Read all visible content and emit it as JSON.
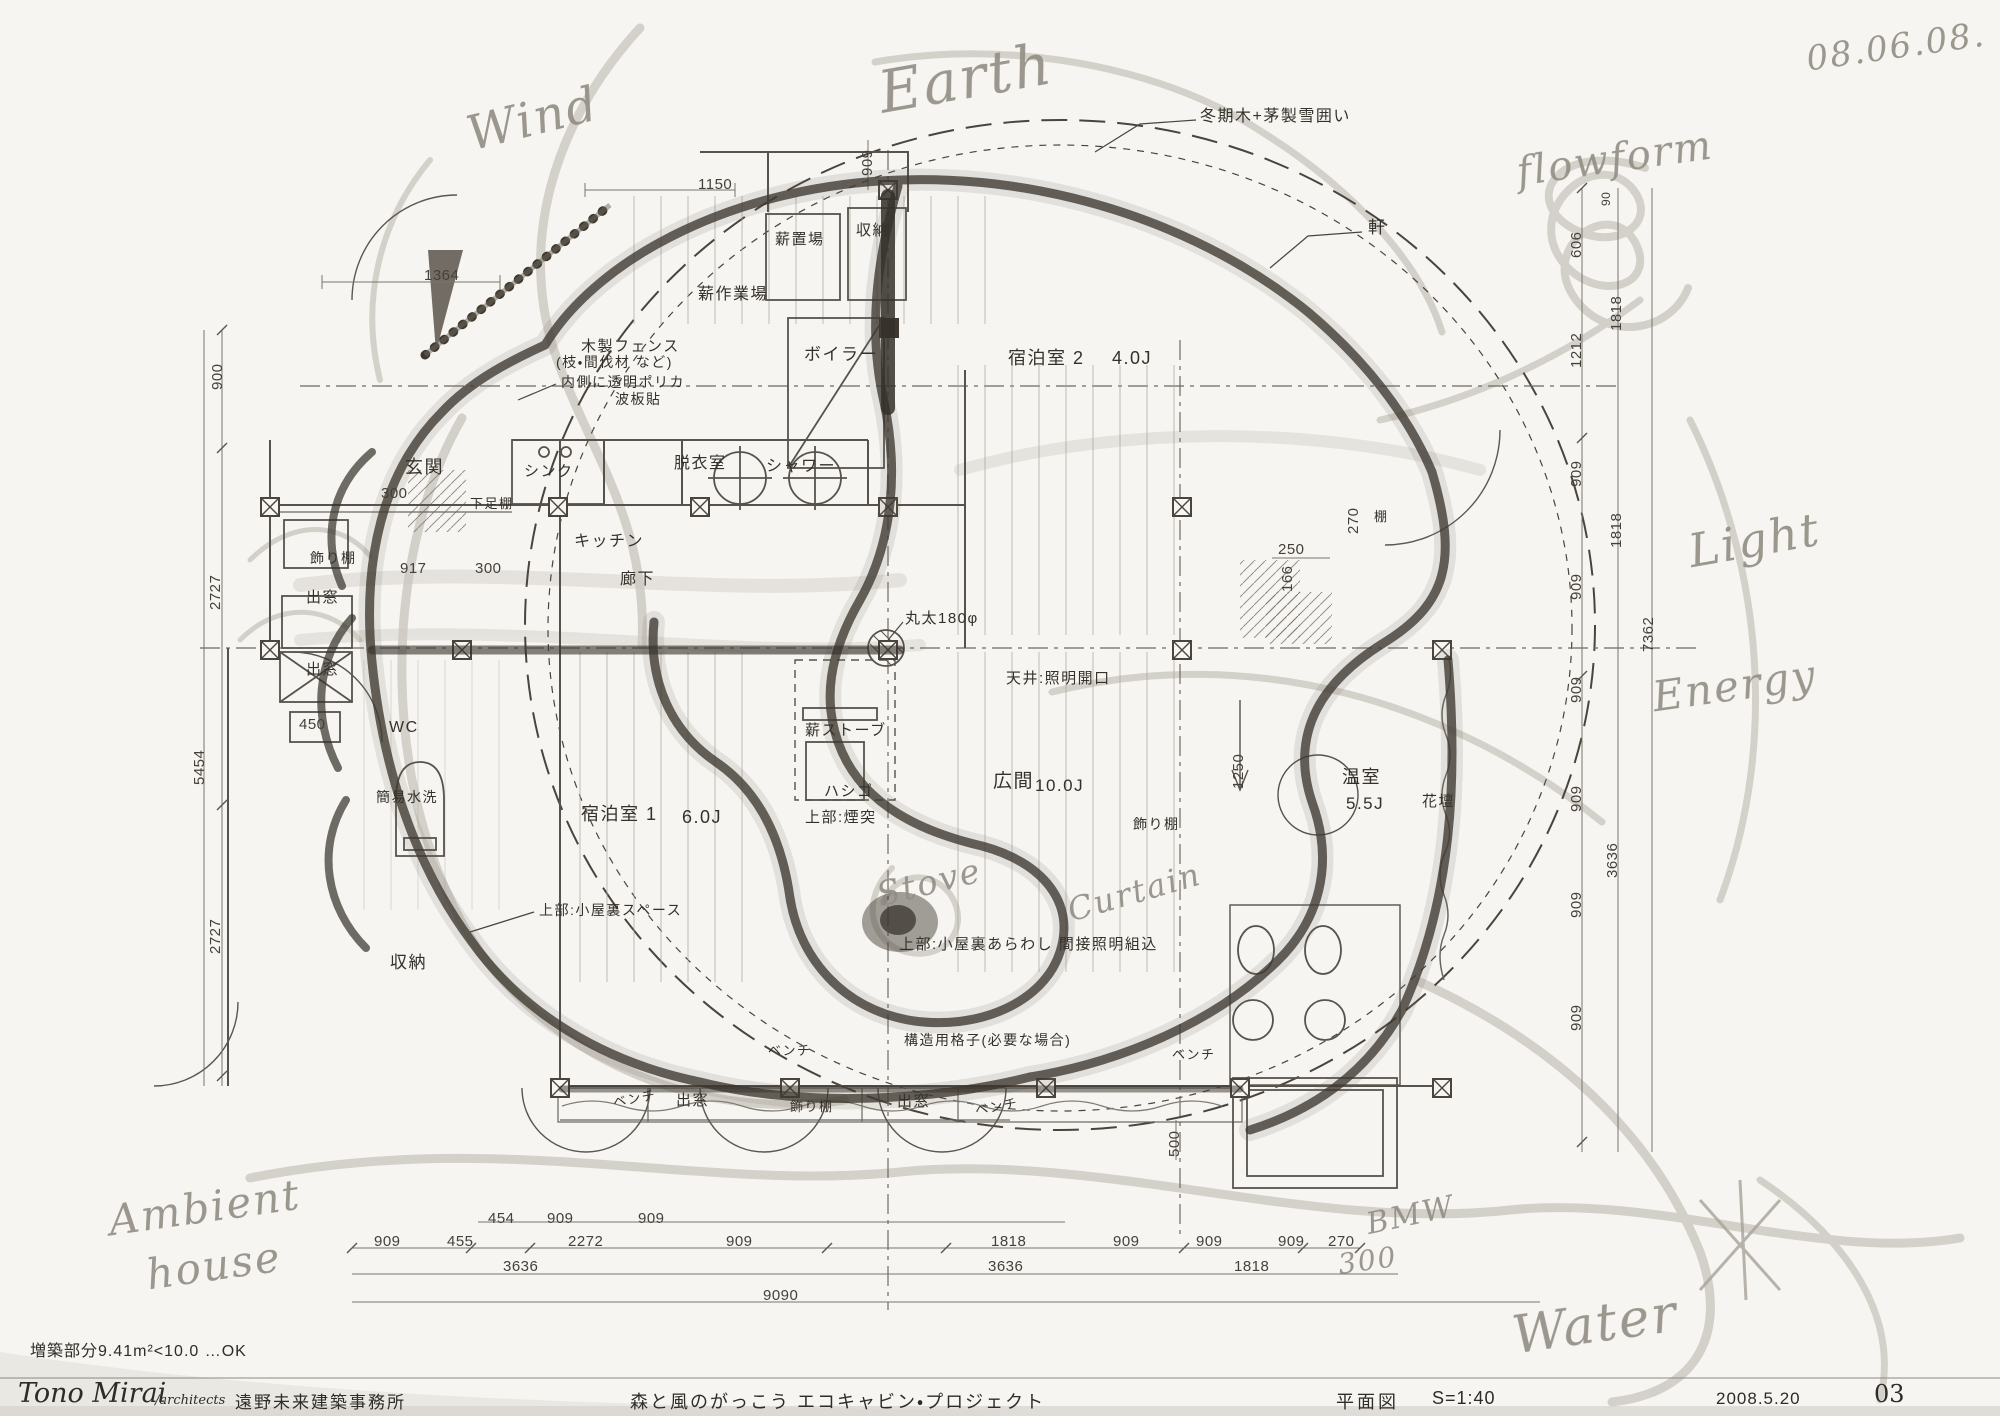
{
  "colors": {
    "paper": "#f6f5f1",
    "ink": "#3a352e",
    "pencil": "#b6b1a7",
    "heavy": "#3e3830"
  },
  "plan": {
    "room_labels": [
      {
        "name": "note-winter-cover",
        "text": "冬期木+茅製雪囲い",
        "x": 1200,
        "y": 109,
        "fs": 16
      },
      {
        "name": "note-eave",
        "text": "軒",
        "x": 1368,
        "y": 219,
        "fs": 17
      },
      {
        "name": "room-firewood-storage",
        "text": "薪置場",
        "x": 775,
        "y": 232,
        "fs": 15
      },
      {
        "name": "room-storage-top",
        "text": "収納",
        "x": 856,
        "y": 223,
        "fs": 15
      },
      {
        "name": "room-firewood-workspace",
        "text": "薪作業場",
        "x": 698,
        "y": 287,
        "fs": 16
      },
      {
        "name": "room-boiler",
        "text": "ボイラー",
        "x": 804,
        "y": 346,
        "fs": 17
      },
      {
        "name": "room-guest2",
        "text": "宿泊室 2",
        "x": 1008,
        "y": 349,
        "fs": 18
      },
      {
        "name": "room-guest2-size",
        "text": "4.0J",
        "x": 1112,
        "y": 349,
        "fs": 18
      },
      {
        "name": "note-wood-fence",
        "text": "木製フェンス",
        "x": 581,
        "y": 339,
        "fs": 15
      },
      {
        "name": "note-wood-fence2",
        "text": "(枝・間伐材 など)",
        "x": 556,
        "y": 355,
        "fs": 14
      },
      {
        "name": "note-polycarb",
        "text": "内側に透明ポリカ",
        "x": 561,
        "y": 375,
        "fs": 14
      },
      {
        "name": "note-polycarb2",
        "text": "波板貼",
        "x": 615,
        "y": 392,
        "fs": 14
      },
      {
        "name": "room-entrance",
        "text": "玄関",
        "x": 405,
        "y": 458,
        "fs": 18
      },
      {
        "name": "note-shoe-shelf",
        "text": "下足棚",
        "x": 470,
        "y": 497,
        "fs": 13
      },
      {
        "name": "fixture-sink",
        "text": "シンク",
        "x": 524,
        "y": 464,
        "fs": 15
      },
      {
        "name": "room-changing",
        "text": "脱衣室",
        "x": 674,
        "y": 456,
        "fs": 16
      },
      {
        "name": "room-shower",
        "text": "シャワー",
        "x": 766,
        "y": 459,
        "fs": 16
      },
      {
        "name": "room-kitchen",
        "text": "キッチン",
        "x": 574,
        "y": 534,
        "fs": 16
      },
      {
        "name": "room-corridor",
        "text": "廊下",
        "x": 620,
        "y": 572,
        "fs": 16
      },
      {
        "name": "fixture-shelf-left",
        "text": "飾り棚",
        "x": 310,
        "y": 551,
        "fs": 14
      },
      {
        "name": "fixture-baywindow-1",
        "text": "出窓",
        "x": 306,
        "y": 590,
        "fs": 15
      },
      {
        "name": "fixture-baywindow-2",
        "text": "出窓",
        "x": 306,
        "y": 662,
        "fs": 15
      },
      {
        "name": "room-wc",
        "text": "WC",
        "x": 389,
        "y": 720,
        "fs": 16
      },
      {
        "name": "fixture-toilet",
        "text": "簡易水洗",
        "x": 376,
        "y": 790,
        "fs": 14
      },
      {
        "name": "note-log-column",
        "text": "丸太180φ",
        "x": 905,
        "y": 611,
        "fs": 15
      },
      {
        "name": "note-ceiling-opening",
        "text": "天井:照明開口",
        "x": 1006,
        "y": 671,
        "fs": 15
      },
      {
        "name": "fixture-wood-stove",
        "text": "薪ストーブ",
        "x": 805,
        "y": 723,
        "fs": 15
      },
      {
        "name": "fixture-ladder",
        "text": "ハシゴ",
        "x": 824,
        "y": 784,
        "fs": 15
      },
      {
        "name": "note-chimney",
        "text": "上部:煙突",
        "x": 805,
        "y": 810,
        "fs": 15
      },
      {
        "name": "room-guest1",
        "text": "宿泊室 1",
        "x": 581,
        "y": 805,
        "fs": 18
      },
      {
        "name": "room-guest1-size",
        "text": "6.0J",
        "x": 682,
        "y": 808,
        "fs": 18
      },
      {
        "name": "room-hall",
        "text": "広間",
        "x": 993,
        "y": 772,
        "fs": 19
      },
      {
        "name": "room-hall-size",
        "text": "10.0J",
        "x": 1035,
        "y": 777,
        "fs": 17
      },
      {
        "name": "fixture-shelf-hall",
        "text": "飾り棚",
        "x": 1133,
        "y": 817,
        "fs": 14
      },
      {
        "name": "room-greenhouse",
        "text": "温室",
        "x": 1342,
        "y": 768,
        "fs": 18
      },
      {
        "name": "room-greenhouse-size",
        "text": "5.5J",
        "x": 1346,
        "y": 795,
        "fs": 17
      },
      {
        "name": "fixture-flowerbed",
        "text": "花壇",
        "x": 1422,
        "y": 794,
        "fs": 15
      },
      {
        "name": "fixture-shelf-small",
        "text": "棚",
        "x": 1374,
        "y": 510,
        "fs": 13
      },
      {
        "name": "room-storage-bottom",
        "text": "収納",
        "x": 390,
        "y": 954,
        "fs": 17
      },
      {
        "name": "note-attic-space",
        "text": "上部:小屋裏スペース",
        "x": 539,
        "y": 903,
        "fs": 14
      },
      {
        "name": "note-attic-exposed",
        "text": "上部:小屋裏あらわし 間接照明組込",
        "x": 899,
        "y": 937,
        "fs": 15
      },
      {
        "name": "note-lattice",
        "text": "構造用格子(必要な場合)",
        "x": 904,
        "y": 1033,
        "fs": 14
      },
      {
        "name": "fixture-bench-1",
        "text": "ベンチ",
        "x": 768,
        "y": 1044,
        "fs": 13
      },
      {
        "name": "fixture-bench-2",
        "text": "ベンチ",
        "x": 1172,
        "y": 1048,
        "fs": 13
      },
      {
        "name": "fixture-bench-3",
        "text": "ベンチ",
        "x": 613,
        "y": 1092,
        "fs": 13,
        "rot": -10
      },
      {
        "name": "fixture-baywindow-3",
        "text": "出窓",
        "x": 676,
        "y": 1093,
        "fs": 15
      },
      {
        "name": "fixture-shelf-bottom",
        "text": "飾り棚",
        "x": 790,
        "y": 1100,
        "fs": 13
      },
      {
        "name": "fixture-baywindow-4",
        "text": "出窓",
        "x": 897,
        "y": 1094,
        "fs": 15
      },
      {
        "name": "fixture-bench-4",
        "text": "ベンチ",
        "x": 975,
        "y": 1100,
        "fs": 13,
        "rot": -10
      }
    ],
    "dims_h": [
      {
        "text": "1150",
        "x": 698,
        "y": 177
      },
      {
        "text": "1364",
        "x": 424,
        "y": 268
      },
      {
        "text": "300",
        "x": 381,
        "y": 486
      },
      {
        "text": "917",
        "x": 400,
        "y": 561
      },
      {
        "text": "300",
        "x": 475,
        "y": 561
      },
      {
        "text": "450",
        "x": 299,
        "y": 717
      },
      {
        "text": "250",
        "x": 1278,
        "y": 542
      },
      {
        "text": "454",
        "x": 488,
        "y": 1211
      },
      {
        "text": "909",
        "x": 547,
        "y": 1211
      },
      {
        "text": "909",
        "x": 638,
        "y": 1211
      },
      {
        "text": "909",
        "x": 374,
        "y": 1234
      },
      {
        "text": "455",
        "x": 447,
        "y": 1234
      },
      {
        "text": "2272",
        "x": 568,
        "y": 1234
      },
      {
        "text": "909",
        "x": 726,
        "y": 1234
      },
      {
        "text": "1818",
        "x": 991,
        "y": 1234
      },
      {
        "text": "909",
        "x": 1113,
        "y": 1234
      },
      {
        "text": "909",
        "x": 1196,
        "y": 1234
      },
      {
        "text": "909",
        "x": 1278,
        "y": 1234
      },
      {
        "text": "270",
        "x": 1328,
        "y": 1234
      },
      {
        "text": "3636",
        "x": 503,
        "y": 1259
      },
      {
        "text": "3636",
        "x": 988,
        "y": 1259
      },
      {
        "text": "1818",
        "x": 1234,
        "y": 1259
      },
      {
        "text": "9090",
        "x": 763,
        "y": 1288
      }
    ],
    "dims_v": [
      {
        "text": "900",
        "x": 210,
        "y": 390
      },
      {
        "text": "2727",
        "x": 208,
        "y": 610
      },
      {
        "text": "5454",
        "x": 192,
        "y": 785
      },
      {
        "text": "2727",
        "x": 208,
        "y": 954
      },
      {
        "text": "909",
        "x": 860,
        "y": 176
      },
      {
        "text": "270",
        "x": 1346,
        "y": 534
      },
      {
        "text": "166",
        "x": 1280,
        "y": 592
      },
      {
        "text": "1250",
        "x": 1231,
        "y": 789
      },
      {
        "text": "500",
        "x": 1167,
        "y": 1157
      },
      {
        "text": "90",
        "x": 1600,
        "y": 206,
        "fs": 12
      },
      {
        "text": "606",
        "x": 1569,
        "y": 258
      },
      {
        "text": "1212",
        "x": 1569,
        "y": 368
      },
      {
        "text": "909",
        "x": 1569,
        "y": 487
      },
      {
        "text": "909",
        "x": 1569,
        "y": 600
      },
      {
        "text": "1818",
        "x": 1609,
        "y": 331
      },
      {
        "text": "1818",
        "x": 1609,
        "y": 548
      },
      {
        "text": "7362",
        "x": 1641,
        "y": 652
      },
      {
        "text": "909",
        "x": 1569,
        "y": 703
      },
      {
        "text": "909",
        "x": 1569,
        "y": 812
      },
      {
        "text": "909",
        "x": 1569,
        "y": 918
      },
      {
        "text": "909",
        "x": 1569,
        "y": 1031
      },
      {
        "text": "3636",
        "x": 1605,
        "y": 878
      }
    ],
    "handwritten": [
      {
        "name": "date-note",
        "text": "08.06.08.",
        "x": 1806,
        "y": 30,
        "fs": 34,
        "rot": -8
      },
      {
        "name": "note-earth",
        "text": "Earth",
        "x": 878,
        "y": 48,
        "fs": 58,
        "rot": -10
      },
      {
        "name": "note-wind",
        "text": "Wind",
        "x": 466,
        "y": 94,
        "fs": 48,
        "rot": -14
      },
      {
        "name": "note-flowform",
        "text": "flowform",
        "x": 1516,
        "y": 138,
        "fs": 40,
        "rot": -8
      },
      {
        "name": "note-light",
        "text": "Light",
        "x": 1688,
        "y": 516,
        "fs": 46,
        "rot": -10
      },
      {
        "name": "note-energy",
        "text": "Energy",
        "x": 1652,
        "y": 664,
        "fs": 42,
        "rot": -8
      },
      {
        "name": "note-stove",
        "text": "Stove",
        "x": 876,
        "y": 866,
        "fs": 34,
        "rot": -14
      },
      {
        "name": "note-curtain",
        "text": "Curtain",
        "x": 1066,
        "y": 876,
        "fs": 32,
        "rot": -16
      },
      {
        "name": "note-ambient",
        "text": "Ambient",
        "x": 108,
        "y": 1186,
        "fs": 42,
        "rot": -8
      },
      {
        "name": "note-house",
        "text": "house",
        "x": 146,
        "y": 1244,
        "fs": 42,
        "rot": -8
      },
      {
        "name": "note-bmw",
        "text": "BMW",
        "x": 1366,
        "y": 1200,
        "fs": 30,
        "rot": -12
      },
      {
        "name": "note-300-hand",
        "text": "300",
        "x": 1338,
        "y": 1246,
        "fs": 28,
        "rot": -8
      },
      {
        "name": "note-water",
        "text": "Water",
        "x": 1512,
        "y": 1298,
        "fs": 52,
        "rot": -8
      }
    ]
  },
  "footer": {
    "area_note": "増築部分9.41m²<10.0  …OK",
    "architect_name": "Tono Mirai",
    "architect_suffix": "/architects",
    "office": "遠野未来建築事務所",
    "project": "森と風のがっこう エコキャビン・プロジェクト",
    "drawing_type": "平面図",
    "scale": "S=1:40",
    "date": "2008.5.20",
    "sheet": "03"
  }
}
